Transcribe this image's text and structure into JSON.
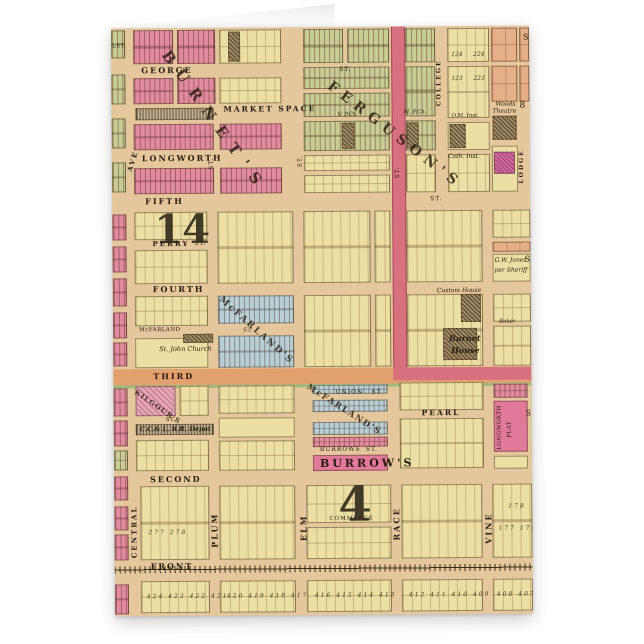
{
  "palette": {
    "card_base_tan": "#e4c79d",
    "block_yellow": "#ecdfa3",
    "block_pink": "#e28ba0",
    "block_green": "#c9cc95",
    "block_blue": "#b9cfd6",
    "block_salmon": "#e5af88",
    "street_highlight_red": "#d8717f",
    "third_street_orange": "#e3a06f",
    "third_street_green_edge": "#9db97c",
    "page_white": "#ffffff"
  },
  "map": {
    "streets": {
      "george": "GEORGE",
      "market_space": "MARKET SPACE",
      "longworth": "LONGWORTH",
      "fifth": "FIFTH",
      "perry": "PERRY",
      "fourth": "FOURTH",
      "third": "THIRD",
      "union": "UNION",
      "pearl": "PEARL",
      "burrows": "BURROWS",
      "second": "SECOND",
      "commerce": "COMMERCE",
      "front": "FRONT",
      "ave": "AVE",
      "central": "CENTRAL",
      "plum": "PLUM",
      "elm": "ELM",
      "race": "RACE",
      "vine": "VINE",
      "college": "COLLEGE",
      "lodge": "LODGE",
      "mcfarland": "McFARLAND",
      "st": "ST."
    },
    "subdivisions": {
      "burnets": "BURNET'S",
      "fergusons": "FERGUSON'S",
      "mcfarlands": "McFARLAND'S",
      "burrows_div": "BURROW'S",
      "kilgours": "KILGOUR'S",
      "longworth_plat_line1": "LONGWORTH",
      "longworth_plat_line2": "PLAT"
    },
    "landmarks": {
      "depot": "C.C.& L. R.R. Depot",
      "burnet_house_line1": "Burnet",
      "burnet_house_line2": "House",
      "woods_theatre_line1": "Woods",
      "woods_theatre_line2": "Theatre",
      "cath_inst": "Cath. Inst.",
      "om_inst": "O.M. Inst.",
      "m_pch": "M. P.Ch.",
      "v_pch": "V. P.Ch.",
      "st_john_church": "St. John Church",
      "gw_jones_line1": "G.W. Jones",
      "gw_jones_line2": "per Sheriff",
      "custom_house": "Custom House",
      "baker": "Baker"
    },
    "numbers": {
      "ward_14": "14",
      "ward_4": "4",
      "block_8": "8",
      "row_424": "424 423 422 421",
      "row_420": "420 419 418 417",
      "row_416": "416 415 414 413",
      "row_412": "412 411 410 409",
      "row_408": "408 407",
      "row_277": "277 278",
      "row_177": "177 178",
      "n178": "178",
      "n123": "123",
      "n124": "124",
      "n223": "223",
      "n224": "224"
    },
    "fragments": {
      "ley": "LEY.",
      "s": "S"
    }
  }
}
